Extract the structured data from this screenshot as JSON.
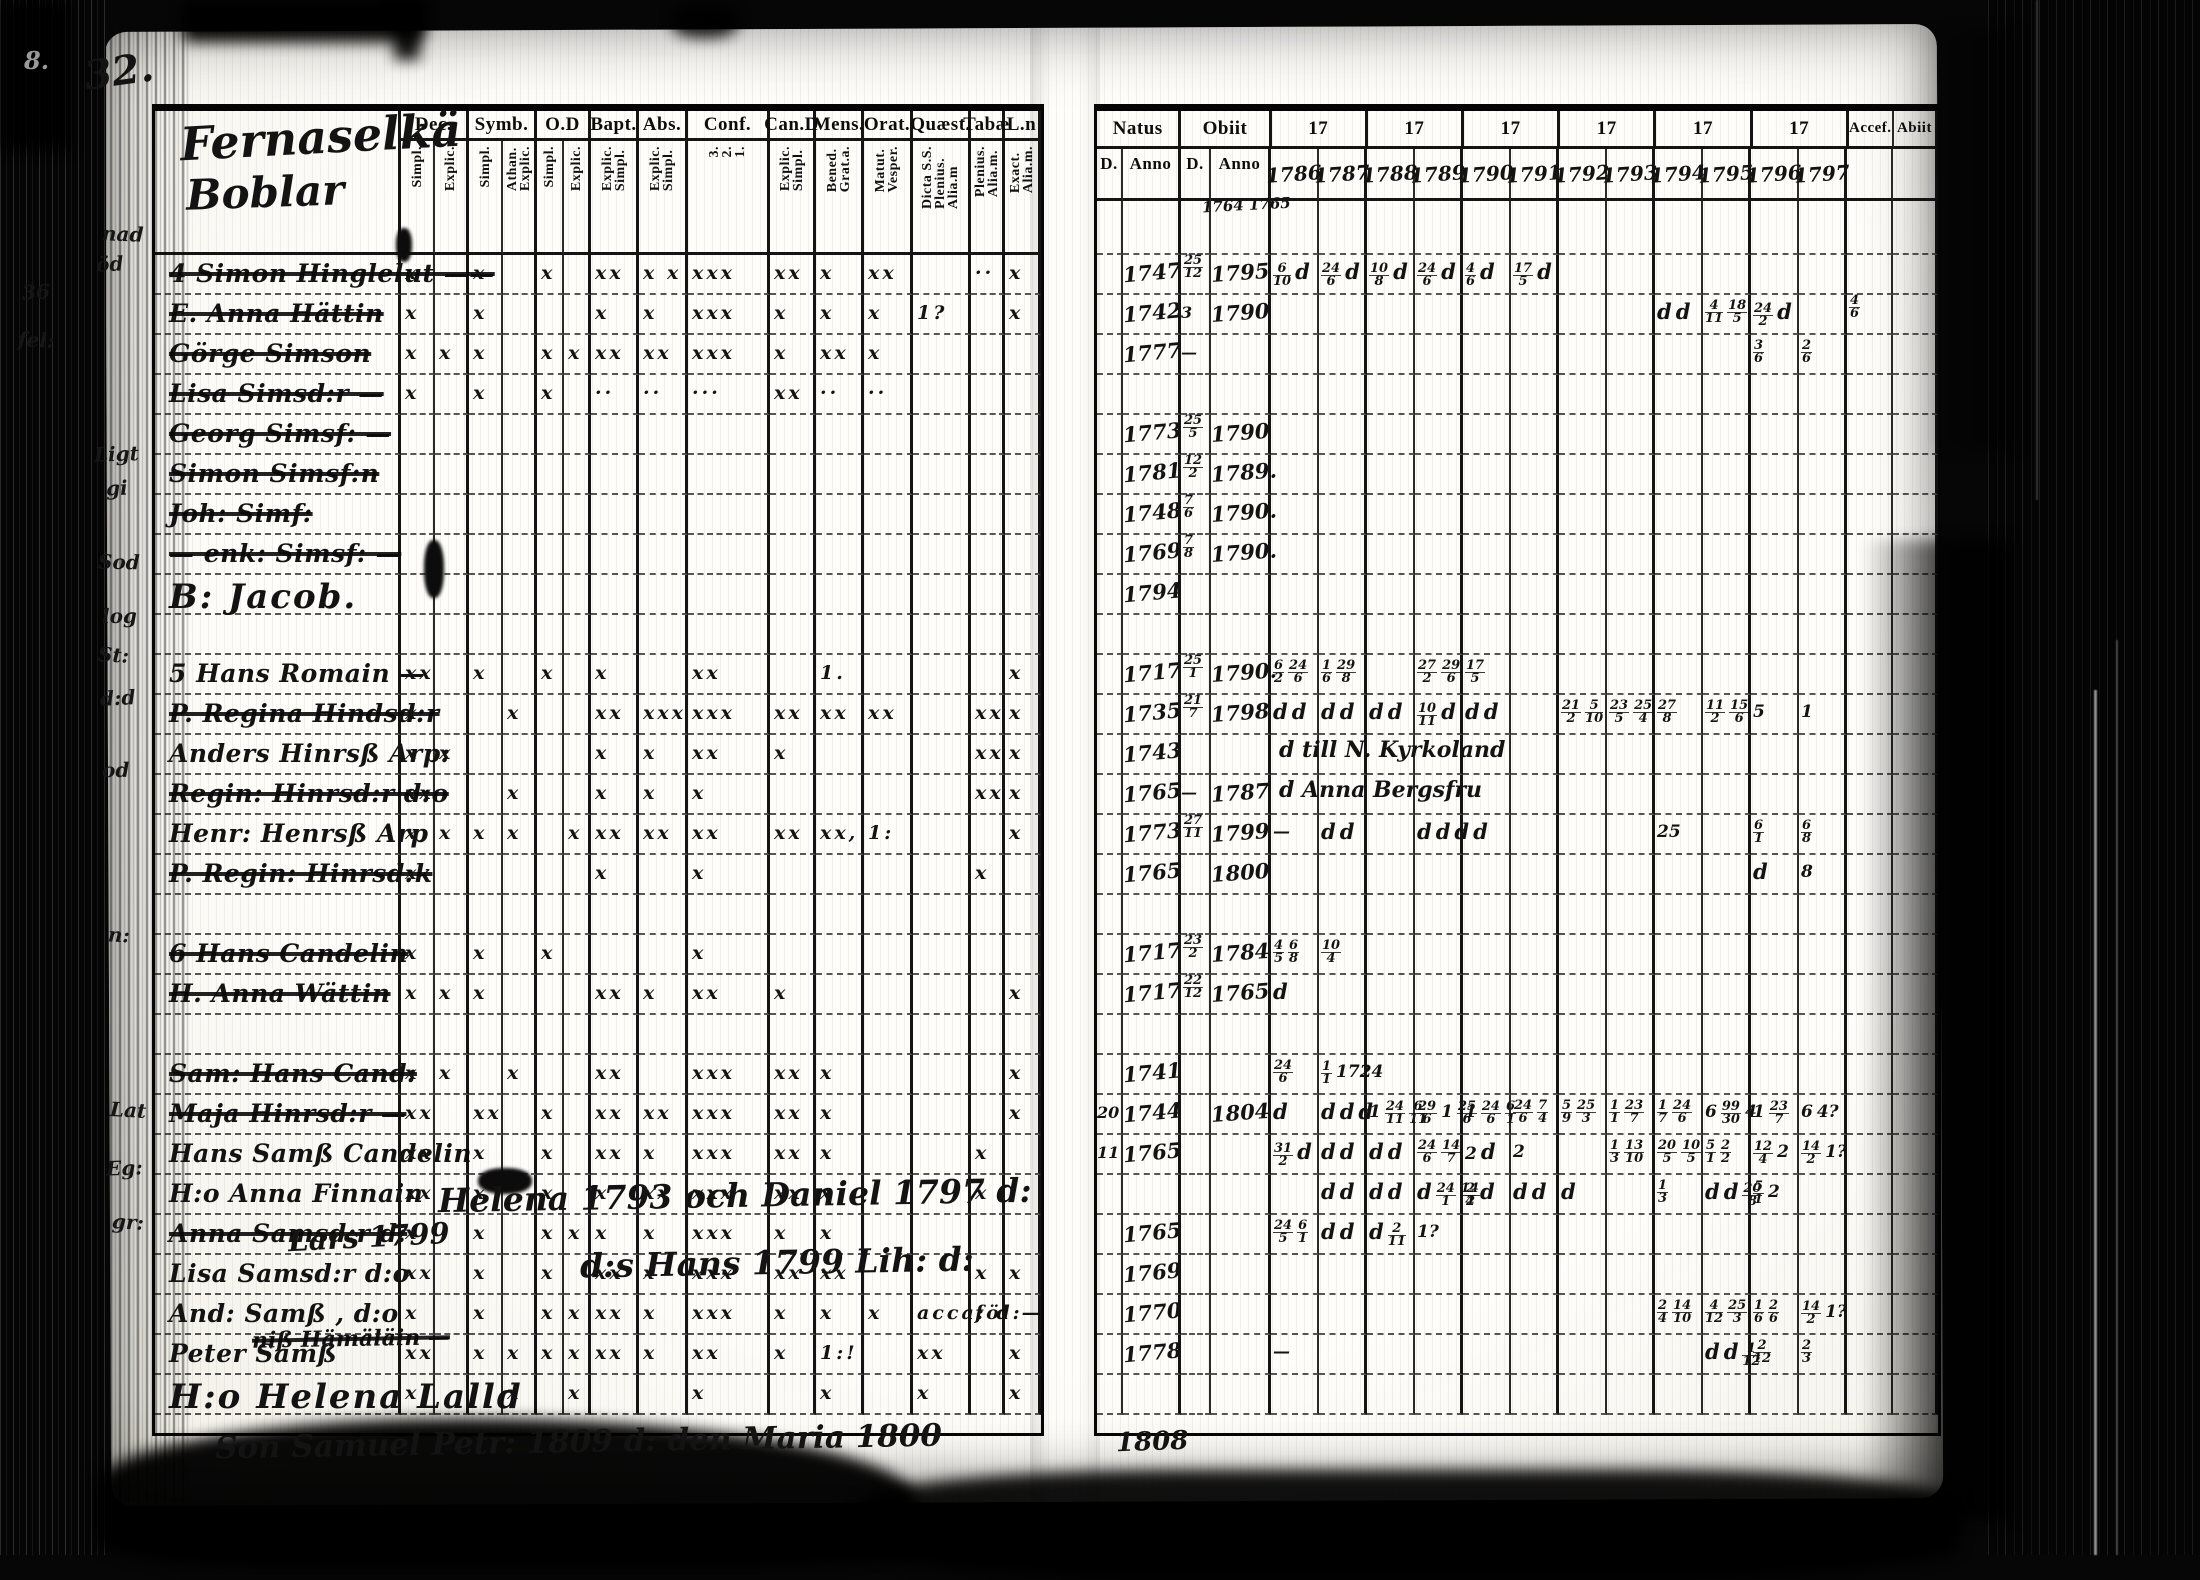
{
  "document": {
    "kind": "parish communion register scan (microfilm, two-page spread)",
    "page_number": "32.",
    "corner_mark": "8.",
    "title_line1": "Fernaselkä",
    "title_line2": "Boblar",
    "ink_color": "#131313",
    "paper_color": "#fdfcf8",
    "film_color": "#060606"
  },
  "left_table": {
    "columns": [
      {
        "label": "Dec.",
        "subs": [
          "Simpl.",
          "Explic."
        ]
      },
      {
        "label": "Symb.",
        "subs": [
          "Simpl.",
          "Athan.|Explic."
        ]
      },
      {
        "label": "O.D",
        "subs": [
          "Simpl.",
          "Explic."
        ]
      },
      {
        "label": "Bapt.",
        "subs": [
          "Explic.|Simpl."
        ]
      },
      {
        "label": "Abs.",
        "subs": [
          "Explic.|Simpl."
        ]
      },
      {
        "label": "Conf.",
        "subs": [
          "3.|2.|1."
        ]
      },
      {
        "label": "Can.D",
        "subs": [
          "Explic.|Simpl."
        ]
      },
      {
        "label": "Mens.",
        "subs": [
          "Bened.|Grat.a."
        ]
      },
      {
        "label": "Orat.",
        "subs": [
          "Matut.|Vesper."
        ]
      },
      {
        "label": "Quæst.",
        "subs": [
          "Dicta S.S.|Plenius.|Alia.m"
        ]
      },
      {
        "label": "Tabæ",
        "subs": [
          "Plenius.|Alia.m."
        ]
      },
      {
        "label": "L.n",
        "subs": [
          "Exact.|Alia.m."
        ]
      }
    ],
    "rows": [
      {
        "name": "4 Simon Hinglelut ——",
        "struck": true,
        "marks": {
          "0": "x",
          "2": "x",
          "4": "x",
          "6": "xx",
          "7": "x x",
          "8": "xxx",
          "9": "xx",
          "10": "x",
          "11": "xx",
          "13": "··",
          "14": "x"
        }
      },
      {
        "name": "E. Anna Hättin",
        "struck": true,
        "marks": {
          "0": "x",
          "2": "x",
          "6": "x",
          "7": "x",
          "8": "xxx",
          "9": "x",
          "10": "x",
          "11": "x",
          "12": "1?",
          "14": "x"
        }
      },
      {
        "name": "Görge Simson",
        "struck": true,
        "marks": {
          "0": "x",
          "1": "x",
          "2": "x",
          "4": "x",
          "5": "x",
          "6": "xx",
          "7": "xx",
          "8": "xxx",
          "9": "x",
          "10": "xx",
          "11": "x"
        }
      },
      {
        "name": "Lisa Simsd:r —",
        "struck": true,
        "marks": {
          "0": "x",
          "2": "x",
          "4": "x",
          "6": "··",
          "7": "··",
          "8": "···",
          "9": "xx",
          "10": "··",
          "11": "··"
        }
      },
      {
        "name": "Georg Simsf: —",
        "struck": true,
        "marks": {}
      },
      {
        "name": "Simon Simsf:n",
        "struck": true,
        "marks": {}
      },
      {
        "name": "Joh: Simf:",
        "struck": true,
        "marks": {}
      },
      {
        "name": "— enk: Simsf: —",
        "struck": true,
        "marks": {}
      },
      {
        "name": "B: Jacob.",
        "big": true,
        "marks": {}
      },
      {
        "name": "",
        "marks": {}
      },
      {
        "name": "5 Hans Romain —",
        "marks": {
          "0": "xx",
          "2": "x",
          "4": "x",
          "6": "x",
          "8": "xx",
          "10": "1.",
          "14": "x"
        }
      },
      {
        "name": "P. Regina Hindsd:r",
        "struck": true,
        "marks": {
          "0": "x",
          "3": "x",
          "6": "xx",
          "7": "xxx",
          "8": "xxx",
          "9": "xx",
          "10": "xx",
          "11": "xx",
          "13": "xx",
          "14": "x"
        }
      },
      {
        "name": "Anders Hinrsß Arp:",
        "marks": {
          "0": "x",
          "1": "x",
          "6": "x",
          "7": "x",
          "8": "xx",
          "9": "x",
          "13": "xx",
          "14": "x"
        }
      },
      {
        "name": "Regin: Hinrsd:r d:o",
        "struck": true,
        "marks": {
          "0": "xx",
          "3": "x",
          "6": "x",
          "7": "x",
          "8": "x",
          "13": "xx",
          "14": "x"
        }
      },
      {
        "name": "Henr: Henrsß Arp",
        "marks": {
          "0": "x",
          "1": "x",
          "2": "x",
          "3": "x",
          "5": "x",
          "6": "xx",
          "7": "xx",
          "8": "xx",
          "9": "xx",
          "10": "xx,",
          "11": "1:",
          "14": "x"
        }
      },
      {
        "name": "P. Regin: Hinrsd:k",
        "struck": true,
        "marks": {
          "0": "x",
          "6": "x",
          "8": "x",
          "13": "x"
        }
      },
      {
        "name": "",
        "marks": {}
      },
      {
        "name": "6 Hans Candelin",
        "struck": true,
        "marks": {
          "0": "x",
          "2": "x",
          "4": "x",
          "8": "x"
        }
      },
      {
        "name": "H. Anna Wättin",
        "struck": true,
        "marks": {
          "0": "x",
          "1": "x",
          "2": "x",
          "6": "xx",
          "7": "x",
          "8": "xx",
          "9": "x",
          "14": "x"
        }
      },
      {
        "name": "",
        "marks": {}
      },
      {
        "name": "Sam: Hans Cand:",
        "struck": true,
        "marks": {
          "0": "x",
          "1": "x",
          "3": "x",
          "6": "xx",
          "8": "xxx",
          "9": "xx",
          "10": "x",
          "14": "x"
        }
      },
      {
        "name": "Maja Hinrsd:r —",
        "struck": true,
        "marks": {
          "0": "xx",
          "2": "xx",
          "4": "x",
          "6": "xx",
          "7": "xx",
          "8": "xxx",
          "9": "xx",
          "10": "x",
          "14": "x"
        }
      },
      {
        "name": "Hans Samß Candelin",
        "marks": {
          "0": "xx",
          "2": "x",
          "4": "x",
          "6": "xx",
          "7": "x",
          "8": "xxx",
          "9": "xx",
          "10": "x",
          "13": "x"
        }
      },
      {
        "name": "H:o Anna Finnain",
        "marks": {
          "0": "xx",
          "2": "x",
          "4": "x",
          "6": "x",
          "7": "xx",
          "8": "xxx",
          "9": "xx",
          "10": "x",
          "13": "x"
        }
      },
      {
        "name": "Anna Samsd:r d:",
        "struck": true,
        "marks": {
          "0": "x",
          "2": "x",
          "4": "x",
          "5": "x",
          "6": "x",
          "7": "x",
          "8": "xxx",
          "9": "x",
          "10": "x"
        }
      },
      {
        "name": "Lisa Samsd:r d:o",
        "marks": {
          "0": "xx",
          "2": "x",
          "4": "x",
          "6": "xx",
          "7": "x",
          "8": "xxx",
          "9": "xx",
          "10": "xx",
          "13": "x",
          "14": "x"
        }
      },
      {
        "name": "And: Samß , d:o",
        "marks": {
          "0": "x",
          "2": "x",
          "4": "x",
          "5": "x",
          "6": "xx",
          "7": "x",
          "8": "xxx",
          "9": "x",
          "10": "x",
          "11": "x",
          "12": "acca: d:",
          "13": "föl —"
        }
      },
      {
        "name": "Peter Samß",
        "marks": {
          "0": "xx",
          "2": "x",
          "3": "x",
          "4": "x",
          "5": "x",
          "6": "xx",
          "7": "x",
          "8": "xx",
          "9": "x",
          "10": "1:!",
          "12": "xx",
          "14": "x"
        }
      },
      {
        "name": "H:o Helena Lalld",
        "big": true,
        "marks": {
          "0": "x",
          "3": "x",
          "5": "x",
          "8": "x",
          "10": "x",
          "12": "x",
          "14": "x"
        }
      }
    ]
  },
  "right_table": {
    "natus_label": "Natus",
    "obiit_label": "Obiit",
    "sub_day": "D.",
    "sub_anno": "Anno",
    "year_prefix": "17",
    "years": [
      "1786",
      "1787",
      "1788",
      "1789",
      "1790",
      "1791",
      "1792",
      "1793",
      "1794",
      "1795",
      "1796",
      "1797"
    ],
    "obiit_note": "1764 1765",
    "accessit_label": "Accef.",
    "abiit_label": "Abiit",
    "rows": [
      {
        "natus": "1747",
        "od": "25/12",
        "oy": "1795",
        "cells": {
          "0": "6/10 d",
          "1": "24/6 d",
          "2": "10/8 d",
          "3": "24/6 d",
          "4": "4/6 d",
          "5": "17/5 d"
        }
      },
      {
        "natus": "1742",
        "od": "3",
        "oy": "1790",
        "cells": {
          "8": "d d",
          "9": "4/11 18/5",
          "10": "24/2 d"
        },
        "accef": "4/6"
      },
      {
        "natus": "1777",
        "od": "—",
        "oy": "",
        "cells": {
          "10": "3/6",
          "11": "2/6"
        }
      },
      {
        "natus": "",
        "od": "",
        "oy": "",
        "cells": {}
      },
      {
        "natus": "1773",
        "od": "25/5",
        "oy": "1790",
        "cells": {}
      },
      {
        "natus": "1781",
        "od": "12/2",
        "oy": "1789.",
        "cells": {}
      },
      {
        "natus": "1748",
        "od": "7/6",
        "oy": "1790.",
        "cells": {}
      },
      {
        "natus": "1769",
        "od": "7/8",
        "oy": "1790.",
        "cells": {}
      },
      {
        "natus": "1794",
        "od": "",
        "oy": "",
        "cells": {}
      },
      {
        "natus": "",
        "od": "",
        "oy": "",
        "cells": {}
      },
      {
        "natus": "1717",
        "od": "25/1",
        "oy": "1790.",
        "cells": {
          "0": "6/2 24/6",
          "1": "1/6 29/8",
          "3": "27/2 29/6",
          "4": "17/5"
        }
      },
      {
        "natus": "1735",
        "od": "21/7",
        "oy": "1798",
        "cells": {
          "0": "d d",
          "1": "d d",
          "2": "d d",
          "3": "10/11 d",
          "4": "d d",
          "6": "21/2 5/10",
          "7": "23/5 25/4",
          "8": "27/8",
          "9": "11/2 15/6",
          "10": "5",
          "11": "1"
        }
      },
      {
        "natus": "1743",
        "od": "",
        "oy": "",
        "note": "d till N. Kyrkoland",
        "cells": {}
      },
      {
        "natus": "1765",
        "od": "—",
        "oy": "1787",
        "note": "d Anna Bergsfru",
        "cells": {}
      },
      {
        "natus": "1773",
        "od": "27/11",
        "oy": "1799",
        "cells": {
          "0": "—",
          "1": "d d",
          "3": "d d d d",
          "8": "25",
          "10": "6/1",
          "11": "6/8"
        }
      },
      {
        "natus": "1765",
        "od": "",
        "oy": "1800",
        "cells": {
          "10": "d",
          "11": "8"
        }
      },
      {
        "natus": "",
        "od": "",
        "oy": "",
        "cells": {}
      },
      {
        "natus": "1717",
        "od": "23/2",
        "oy": "1784",
        "cells": {
          "0": "4/5 6/8",
          "1": "10/4"
        }
      },
      {
        "natus": "1717",
        "od": "22/12",
        "oy": "1765",
        "cells": {
          "0": "d"
        }
      },
      {
        "natus": "",
        "od": "",
        "oy": "",
        "cells": {}
      },
      {
        "natus": "1741",
        "od": "",
        "oy": "",
        "cells": {
          "0": "24/6",
          "1": "1/1 1724"
        }
      },
      {
        "natus": "1744",
        "nd": "20",
        "od": "",
        "oy": "1804",
        "cells": {
          "0": "d",
          "1": "d d d",
          "2": "1 24/11 6/11",
          "3": "29/6 1 25/6",
          "4": "1 24/6 6/1",
          "5": "24/6 7/4",
          "6": "5/9 25/3",
          "7": "1/1 23/7",
          "8": "1/7 24/6",
          "9": "6 99/30 4",
          "10": "1 23/7",
          "11": "6 4?"
        }
      },
      {
        "natus": "1765",
        "nd": "11",
        "od": "",
        "oy": "",
        "cells": {
          "0": "31/2 d",
          "1": "d d",
          "2": "d d",
          "3": "24/6 14/7",
          "4": "2 d",
          "5": "2",
          "7": "1/3 13/10",
          "8": "20/5 10/5",
          "9": "5/1 2/2",
          "10": "12/4 2",
          "11": "14/2 1?"
        }
      },
      {
        "natus": "",
        "od": "",
        "oy": "",
        "cells": {
          "1": "d d",
          "2": "d d",
          "3": "d 24/1 14/4",
          "4": "2/2 d",
          "5": "d d",
          "6": "d",
          "8": "1/3",
          "9": "d d 20/8",
          "10": "5/1 2"
        }
      },
      {
        "natus": "1765",
        "od": "",
        "oy": "",
        "cells": {
          "0": "24/5 6/1",
          "1": "d d",
          "2": "d 2/11",
          "3": "1?"
        }
      },
      {
        "natus": "1769",
        "od": "",
        "oy": "",
        "cells": {}
      },
      {
        "natus": "1770",
        "od": "",
        "oy": "",
        "cells": {
          "8": "2/4 14/10",
          "9": "4/12 25/3",
          "10": "1/6 2/6",
          "11": "14/2 1?"
        }
      },
      {
        "natus": "1778",
        "od": "",
        "oy": "",
        "cells": {
          "0": "—",
          "9": "d d 1/12",
          "10": "2/12",
          "11": "2/3"
        }
      },
      {
        "natus": "",
        "od": "",
        "oy": "",
        "cells": {}
      }
    ]
  },
  "annotations": [
    {
      "text": "32.",
      "x": 84,
      "y": 48,
      "size": 40,
      "rot": -8
    },
    {
      "text": "8.",
      "x": 24,
      "y": 46,
      "size": 24,
      "rot": 0,
      "light": true
    },
    {
      "text": "1764 1765",
      "x": 1202,
      "y": 196,
      "size": 15,
      "rot": -3
    },
    {
      "text": "Helena 1793 och Daniel 1797 d:",
      "x": 438,
      "y": 1176,
      "size": 33,
      "rot": -1
    },
    {
      "text": "Lars 1799",
      "x": 288,
      "y": 1220,
      "size": 29,
      "rot": -3
    },
    {
      "text": "d:s Hans 1799 Lih: d:",
      "x": 580,
      "y": 1243,
      "size": 33,
      "rot": -1
    },
    {
      "text": "niß Hämäläin —",
      "x": 252,
      "y": 1326,
      "size": 22,
      "rot": -1,
      "struck": true
    },
    {
      "text": "Son Samuel Petr: 1809 d: den Maria 1800",
      "x": 215,
      "y": 1424,
      "size": 31,
      "rot": -1
    },
    {
      "text": "1808",
      "x": 1116,
      "y": 1427,
      "size": 26,
      "rot": -2
    }
  ],
  "marginalia": [
    {
      "t": "nad",
      "x": 102,
      "y": 222
    },
    {
      "t": "öd",
      "x": 96,
      "y": 252
    },
    {
      "t": "36",
      "x": 22,
      "y": 280
    },
    {
      "t": "fel:",
      "x": 18,
      "y": 328
    },
    {
      "t": "Ligt",
      "x": 94,
      "y": 442
    },
    {
      "t": "gi",
      "x": 106,
      "y": 476
    },
    {
      "t": "Sod",
      "x": 98,
      "y": 550
    },
    {
      "t": "log",
      "x": 102,
      "y": 604
    },
    {
      "t": "St:",
      "x": 98,
      "y": 643
    },
    {
      "t": "d:d",
      "x": 100,
      "y": 686
    },
    {
      "t": "od",
      "x": 102,
      "y": 758
    },
    {
      "t": "n:",
      "x": 108,
      "y": 923
    },
    {
      "t": "Lat",
      "x": 110,
      "y": 1098
    },
    {
      "t": "Eg:",
      "x": 106,
      "y": 1156
    },
    {
      "t": "gr:",
      "x": 112,
      "y": 1210
    }
  ]
}
